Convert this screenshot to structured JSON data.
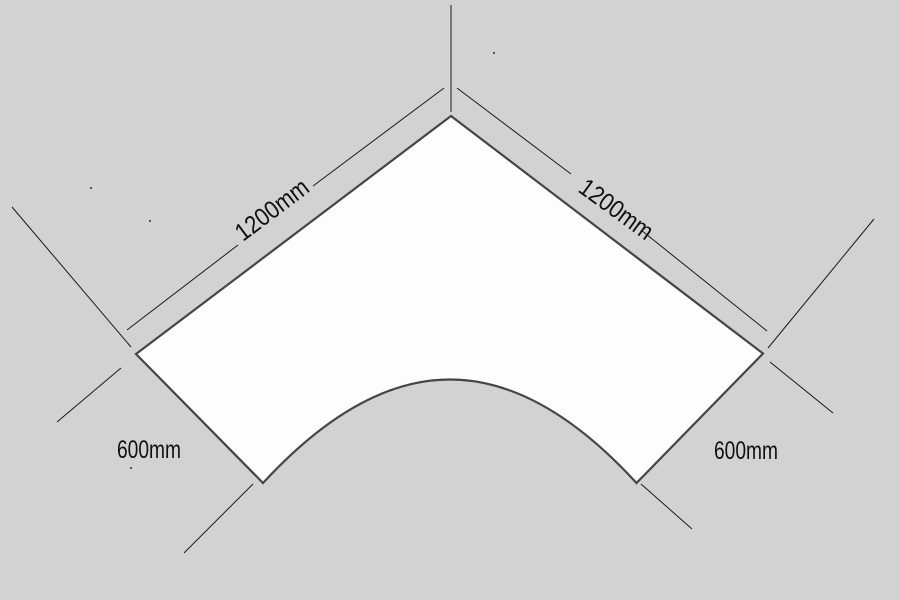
{
  "drawing": {
    "type": "dimensioned technical drawing",
    "subject": "corner desk top with curved front cutout",
    "background_color": "#d2d2d2",
    "surface_fill": "#fdfdfd",
    "surface_outline_color": "#454545",
    "construction_line_color": "#1a1a1a",
    "text_color": "#101010",
    "labels": {
      "dim_top_left_edge": "1200mm",
      "dim_top_right_edge": "1200mm",
      "dim_left_side": "600mm",
      "dim_right_side": "600mm"
    },
    "dimensions_mm": {
      "top_left_edge": 1200,
      "top_right_edge": 1200,
      "left_side": 600,
      "right_side": 600
    }
  }
}
